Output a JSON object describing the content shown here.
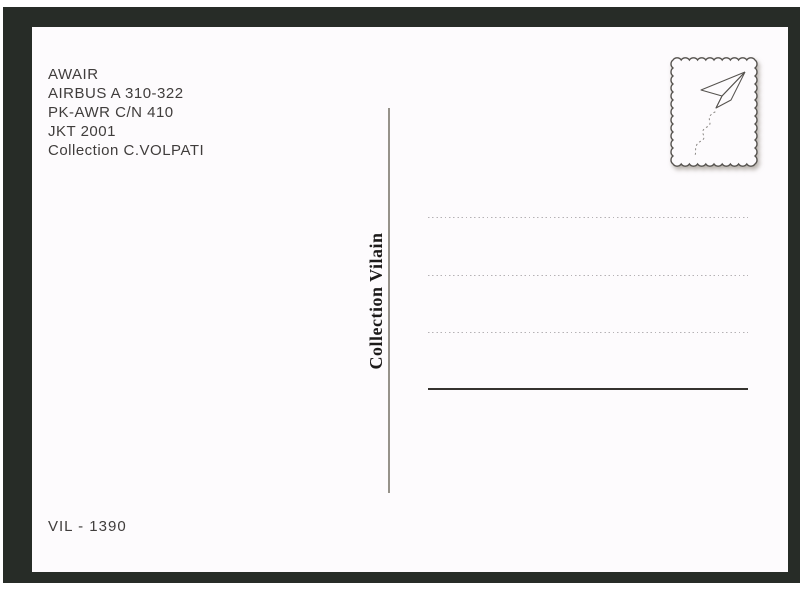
{
  "postcard": {
    "header": {
      "lines": [
        "AWAIR",
        "AIRBUS A 310-322",
        "PK-AWR C/N 410",
        "JKT 2001",
        "Collection C.VOLPATI"
      ]
    },
    "stamp_box": {
      "icon": "paper-airplane-icon",
      "style": "wavy-scalloped-border"
    },
    "publisher_vertical_label": "Collection Vilain",
    "catalog_number": "VIL - 1390",
    "address_area": {
      "dotted_lines_count": 3,
      "has_solid_bottom_line": true
    },
    "colors": {
      "frame": "#272c27",
      "card": "#fdfbfd",
      "text": "#403d3c",
      "divider": "#96928a",
      "dotted_line": "#b5b2b5",
      "signature_line": "#35332f",
      "stamp_outline": "#55524e"
    }
  }
}
